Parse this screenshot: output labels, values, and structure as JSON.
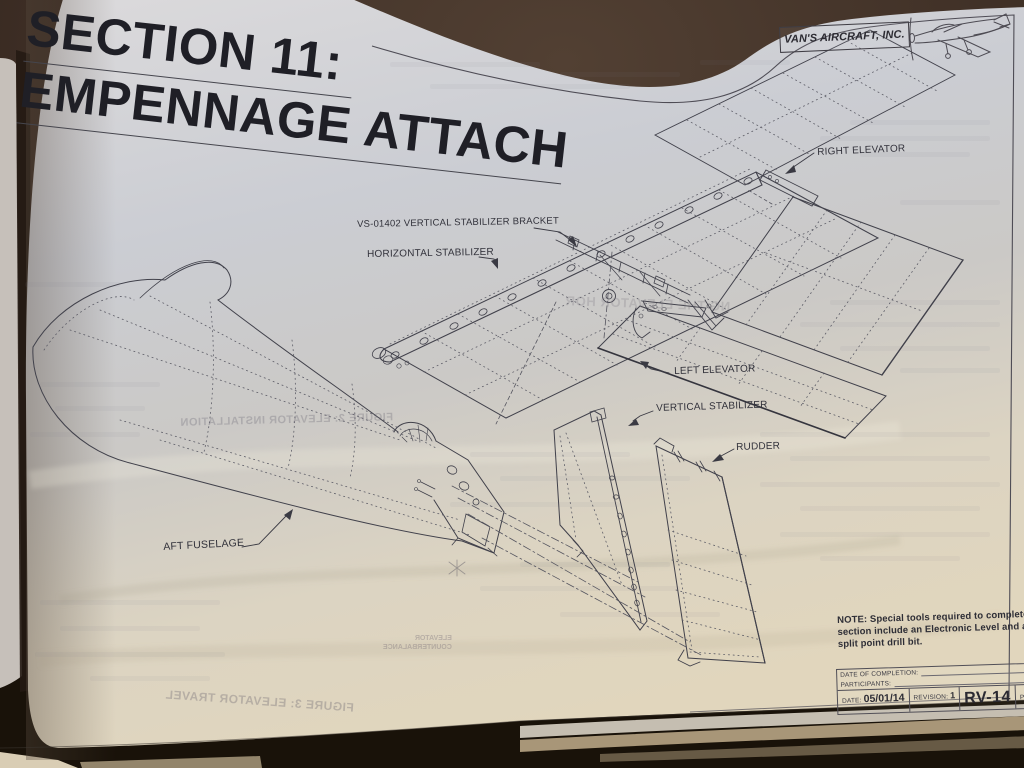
{
  "document": {
    "section_title_line1": "SECTION 11:",
    "section_title_line2": "EMPENNAGE ATTACH",
    "company": "VAN'S AIRCRAFT, INC."
  },
  "diagram": {
    "labels": [
      {
        "id": "right-elevator",
        "text": "RIGHT ELEVATOR"
      },
      {
        "id": "vs-bracket",
        "text": "VS-01402 VERTICAL STABILIZER BRACKET"
      },
      {
        "id": "horizontal-stabilizer",
        "text": "HORIZONTAL STABILIZER"
      },
      {
        "id": "left-elevator",
        "text": "LEFT ELEVATOR"
      },
      {
        "id": "vertical-stabilizer",
        "text": "VERTICAL STABILIZER"
      },
      {
        "id": "rudder",
        "text": "RUDDER"
      },
      {
        "id": "aft-fuselage",
        "text": "AFT FUSELAGE"
      }
    ]
  },
  "note": {
    "lines": [
      "NOTE: Special tools required to complete thi",
      "section include an Electronic Level and a #3",
      "split point drill bit."
    ]
  },
  "title_block": {
    "date_of_completion_label": "DATE OF COMPLETION:",
    "participants_label": "PARTICIPANTS:",
    "date_label": "DATE:",
    "date_value": "05/01/14",
    "revision_label": "REVISION:",
    "revision_value": "1",
    "model": "RV-14",
    "page_label": "PAGE",
    "page_value": "1"
  },
  "bleedthrough": {
    "figure2": "FIGURE 2: ELEVATOR INSTALLATION",
    "figure3": "FIGURE 3: ELEVATOR TRAVEL",
    "heading": "NG THE ELEVATOR HOR",
    "counterbalance_line1": "ELEVATOR",
    "counterbalance_line2": "COUNTERBALANCE"
  },
  "colors": {
    "desk_background": "#3c2d24",
    "paper_cool": "#c9cbd0",
    "paper_warm": "#e0d6bf",
    "ink": "#23232a",
    "line_ink": "#41414b"
  }
}
